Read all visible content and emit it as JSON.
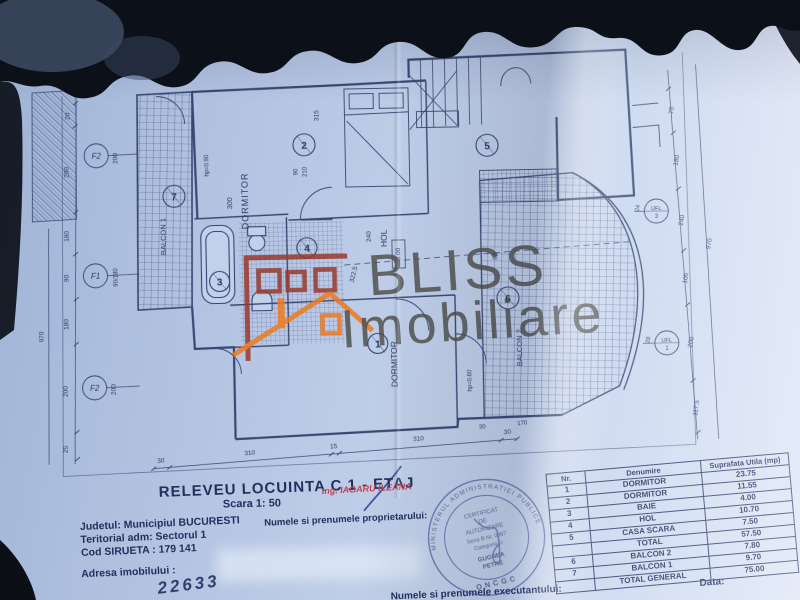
{
  "photo": {
    "background_color": "#0b1019",
    "paper_color": "#bccbe6"
  },
  "watermark": {
    "brand_line1": "BLISS",
    "brand_line2": "Imobiliare",
    "building_color": "#9a392a",
    "roof_color": "#ef7a1e",
    "text_color": "#4e4e49"
  },
  "plan": {
    "room_labels": {
      "dormitor_top": "DORMITOR",
      "dormitor_bottom": "DORMITOR",
      "hol": "HOL",
      "hol_level": "+3.00",
      "balcon1": "BALCON 1",
      "balcon2": "BALCON 2"
    },
    "room_numbers": [
      "1",
      "2",
      "3",
      "4",
      "5",
      "6",
      "7"
    ],
    "window_marks": [
      {
        "mark": "F2",
        "dim": "200"
      },
      {
        "mark": "F1",
        "dim": "90/180"
      },
      {
        "mark": "F2",
        "dim": "200"
      }
    ],
    "level_marks": [
      {
        "label": "UFL",
        "num": "3",
        "dim": "24"
      },
      {
        "label": "UFL",
        "num": "1",
        "dim": "28"
      }
    ],
    "dims": {
      "left_chain": [
        "20",
        "200",
        "180",
        "90",
        "180",
        "200",
        "25"
      ],
      "left_total": "970",
      "right_chain": [
        "75",
        "180",
        "240",
        "105",
        "200",
        "117.5"
      ],
      "right_total": "970",
      "bottom_chain": [
        "30",
        "310",
        "15",
        "310",
        "30"
      ],
      "top": "315",
      "door_w": "90",
      "door_h": "210",
      "hol_width": "240",
      "hol_length": "322.5",
      "dorm_width": "300",
      "balcon2_width": "90",
      "balcon2_b1": "30",
      "balcon2_b2": "170",
      "parapet_high": "hp=0.90",
      "parapet_low": "hp=0.60"
    }
  },
  "title_block": {
    "title": "RELEVEU  LOCUINTA C 1 - ETAJ",
    "scale": "Scara 1: 50",
    "engineer": "Ing. IAGARU ILEANA"
  },
  "info": {
    "line1": "Judetul: Municipiul BUCURESTI",
    "line2": "Teritorial adm:  Sectorul 1",
    "line3": "Cod SIRUETA : 179 141",
    "address_label": "Adresa imobilului :",
    "handwritten": "22633",
    "owner_label": "Numele si prenumele proprietarului:",
    "executant_label": "Numele si prenumele executantului:",
    "date_label": "Data:"
  },
  "stamp": {
    "ring_top": "MINISTERUL ADMINISTRATIEI PUBLICE",
    "ring_bottom": "ONCGC",
    "line1": "CERTIFICAT",
    "line2": "DE",
    "line3": "AUTORIZARE",
    "line4": "Seria B Nr. 0387",
    "line5": "Categoria D",
    "line6": "GUGNEA",
    "line7": "PETRE"
  },
  "table": {
    "headers": [
      "Nr.",
      "Denumire",
      "Suprafata Utila (mp)"
    ],
    "rows": [
      [
        "1",
        "DORMITOR",
        "23.75"
      ],
      [
        "2",
        "DORMITOR",
        "11.55"
      ],
      [
        "3",
        "BAIE",
        "4.00"
      ],
      [
        "4",
        "HOL",
        "10.70"
      ],
      [
        "5",
        "CASA SCARA",
        "7.50"
      ],
      [
        "",
        "TOTAL",
        "57.50"
      ],
      [
        "6",
        "BALCON 2",
        "7.80"
      ],
      [
        "7",
        "BALCON 1",
        "9.70"
      ],
      [
        "",
        "TOTAL GENERAL",
        "75.00"
      ]
    ]
  }
}
